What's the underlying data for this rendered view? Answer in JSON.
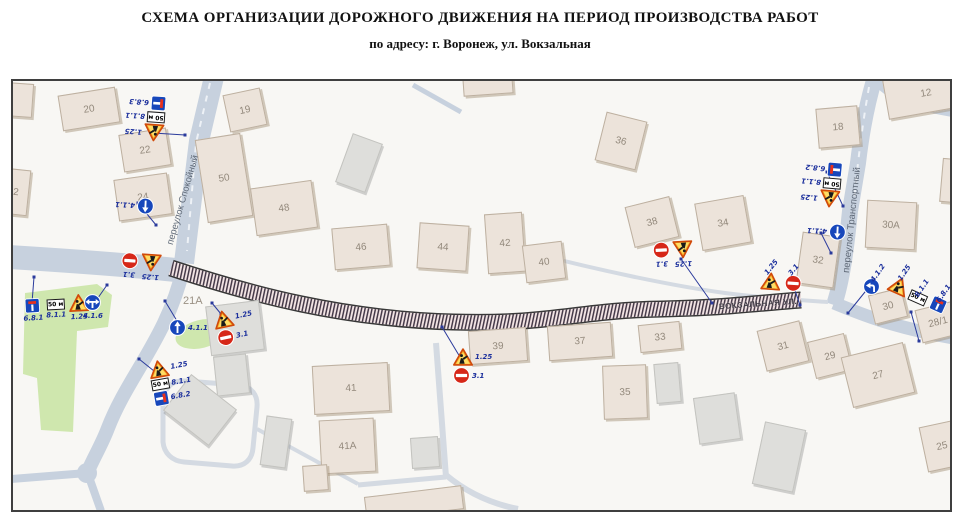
{
  "title": "СХЕМА  ОРГАНИЗАЦИИ ДОРОЖНОГО ДВИЖЕНИЯ НА ПЕРИОД ПРОИЗВОДСТВА РАБОТ",
  "subtitle": "по адресу: г. Воронеж, ул. Вокзальная",
  "map": {
    "streets": {
      "spokoyny": "переулок Спокойный",
      "transportny": "переулок Транспортный",
      "vokzalnaya": "ВОКЗАЛЬНАЯ УЛ."
    },
    "buildings": {
      "b2": "2",
      "b12": "12",
      "b18": "18",
      "b19": "19",
      "b20": "20",
      "b21A": "21A",
      "b22": "22",
      "b24": "24",
      "b25": "25",
      "b27": "27",
      "b28_1": "28/1",
      "b29": "29",
      "b30": "30",
      "b30A": "30A",
      "b31": "31",
      "b32": "32",
      "b33": "33",
      "b34": "34",
      "b35": "35",
      "b36": "36",
      "b37": "37",
      "b38": "38",
      "b39": "39",
      "b40": "40",
      "b41": "41",
      "b41A": "41A",
      "b42": "42",
      "b44": "44",
      "b46": "46",
      "b48": "48",
      "b50": "50"
    },
    "sign_codes": {
      "roadworks": "1.25",
      "no_entry": "3.1",
      "go_straight": "4.1.1",
      "turn": "4.1.2",
      "right_or_left": "4.1.6",
      "dead_end_straight": "6.8.1",
      "dead_end_right": "6.8.2",
      "dead_end_left": "6.8.3",
      "distance_plate": "8.1.1"
    },
    "plate_50m": "50 м"
  }
}
